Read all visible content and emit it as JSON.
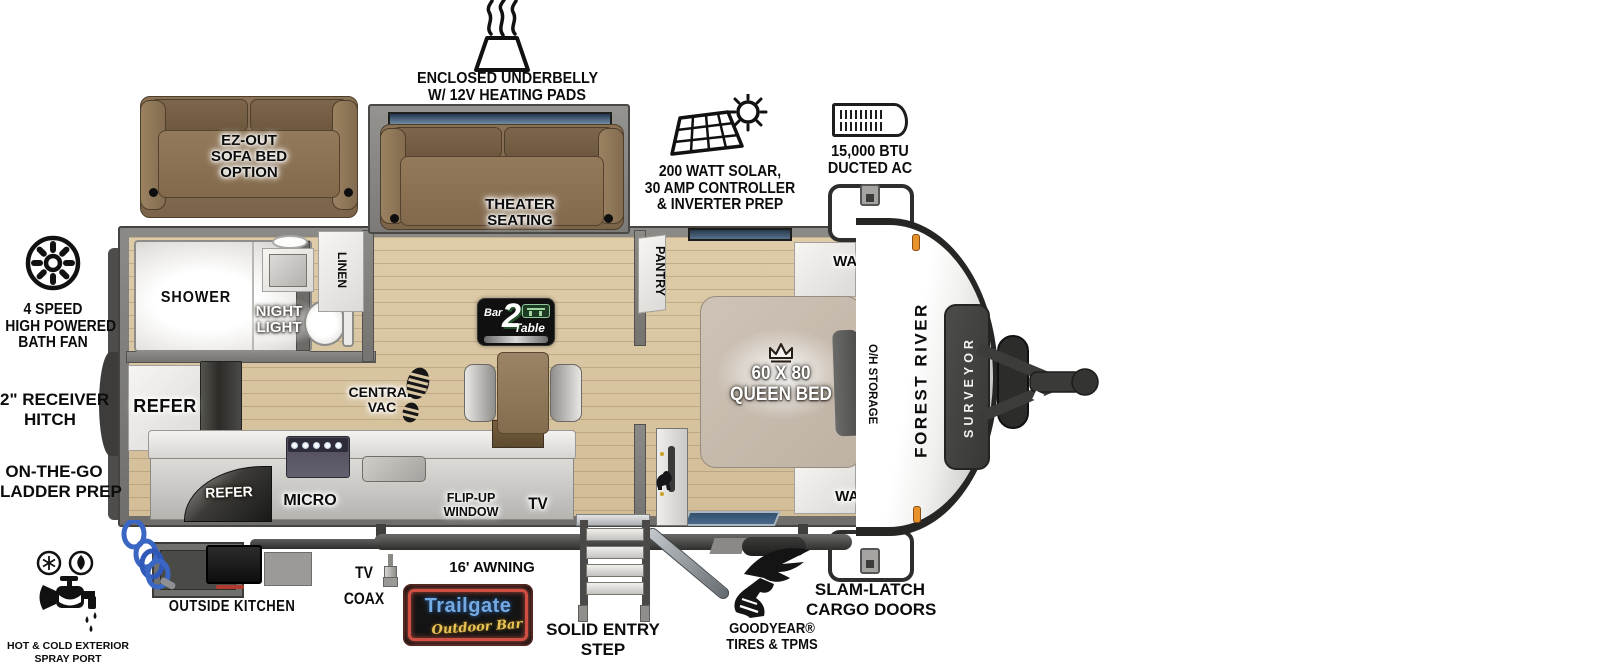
{
  "title": "Forest River Surveyor travel trailer floorplan",
  "colors": {
    "wall_gray": "#7f7e7a",
    "floor_wood": "#d9c6a2",
    "sofa_brown": "#856d4f",
    "bed_tan": "#c8bcae",
    "window_blue": "#33516d",
    "marker_orange": "#e8922c",
    "neon_red": "#d0493c",
    "neon_blue": "#74a9e2",
    "neon_yellow": "#e9c355",
    "hose_blue": "#3a66c4",
    "ink": "#0c0c0c"
  },
  "callouts": {
    "underbelly": {
      "l1": "ENCLOSED UNDERBELLY",
      "l2": "W/ 12V HEATING PADS"
    },
    "solar": {
      "l1": "200 WATT SOLAR,",
      "l2": "30 AMP CONTROLLER",
      "l3": "& INVERTER PREP"
    },
    "ducted_ac": {
      "l1": "15,000 BTU",
      "l2": "DUCTED AC"
    },
    "bath_fan": {
      "l1": "4 SPEED",
      "l2": "HIGH POWERED",
      "l3": "BATH FAN"
    },
    "receiver_hitch": {
      "l1": "2\" RECEIVER",
      "l2": "HITCH"
    },
    "ladder_prep": {
      "l1": "ON-THE-GO",
      "l2": "LADDER PREP"
    },
    "spray_port": {
      "l1": "HOT & COLD EXTERIOR",
      "l2": "SPRAY PORT"
    },
    "outside_kitchen": "OUTSIDE KITCHEN",
    "tv_coax": {
      "l1": "TV",
      "l2": "COAX"
    },
    "awning": "16' AWNING",
    "entry_step": {
      "l1": "SOLID ENTRY",
      "l2": "STEP"
    },
    "goodyear": {
      "l1": "GOODYEAR®",
      "l2": "TIRES & TPMS"
    },
    "cargo_doors": {
      "l1": "SLAM-LATCH",
      "l2": "CARGO DOORS"
    }
  },
  "rooms": {
    "sofa_option": {
      "l1": "EZ-OUT",
      "l2": "SOFA BED",
      "l3": "OPTION"
    },
    "theater": {
      "l1": "THEATER",
      "l2": "SEATING"
    },
    "shower": "SHOWER",
    "night_light": {
      "l1": "NIGHT",
      "l2": "LIGHT"
    },
    "linen": "LINEN",
    "refer": "REFER",
    "refer_outside": "REFER",
    "micro": "MICRO",
    "central_vac": {
      "l1": "CENTRAL",
      "l2": "VAC"
    },
    "pantry": "PANTRY",
    "bed": {
      "size": "60 X 80",
      "type": "QUEEN BED"
    },
    "ward_top": "WARD",
    "ward_bottom": "WARD",
    "oh_storage": "O/H STORAGE",
    "flip_window": {
      "l1": "FLIP-UP",
      "l2": "WINDOW"
    },
    "tv": "TV"
  },
  "branding": {
    "make": "FOREST RIVER",
    "model": "SURVEYOR",
    "bar2table": {
      "bar": "Bar",
      "num": "2",
      "table": "Table"
    },
    "trailgate": {
      "name": "Trailgate",
      "tagline": "Outdoor Bar"
    }
  }
}
